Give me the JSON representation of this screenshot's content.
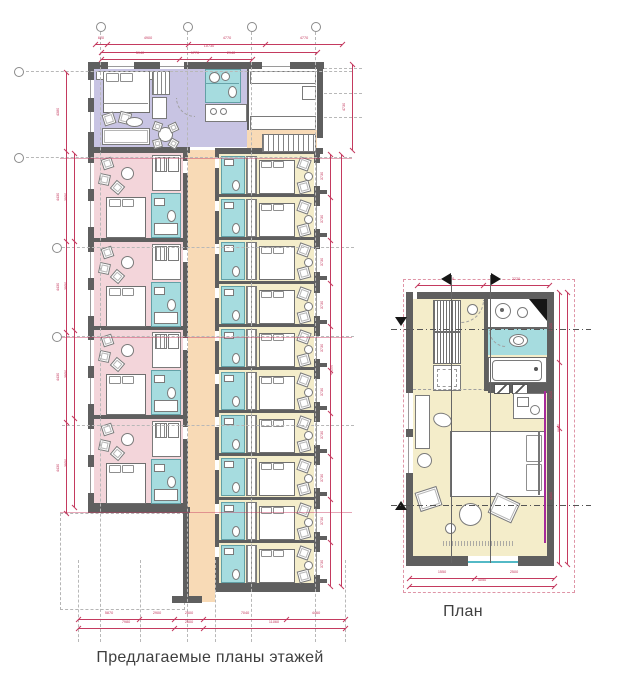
{
  "captions": {
    "main": "Предлагаемые планы этажей",
    "detail": "План"
  },
  "colors": {
    "wall": "#5f5f5f",
    "suite": "#c8c4e3",
    "room_large": "#f3d5da",
    "room_standard": "#f4edca",
    "bathroom": "#a6dcdf",
    "corridor": "#f8dab6",
    "dimension": "#c43a5f"
  },
  "main_plan": {
    "left_room_count": 4,
    "right_room_count": 10,
    "dims": {
      "top_outer": [
        "620",
        "4900",
        "4770",
        "4770"
      ],
      "top_overall": [
        "10730"
      ],
      "top_inner": [
        "5940",
        "1770",
        "2940"
      ],
      "top_right_side": [
        "4730"
      ],
      "bottom_row1": [
        "5870",
        "2900",
        "2600",
        "7040",
        "4460"
      ],
      "bottom_row2": [
        "7980",
        "2600",
        "11060"
      ],
      "left_outer": [
        "4380",
        "4430",
        "4430",
        "4430",
        "4430"
      ],
      "left_inner": [
        "3950",
        "3950",
        "3950",
        "3950"
      ],
      "right_rooms": [
        "3730",
        "3730",
        "3730",
        "3730",
        "3730",
        "3730",
        "3730",
        "3730",
        "3730",
        "3730"
      ],
      "right_overall": [
        "43200"
      ]
    }
  },
  "detail_plan": {
    "dims": {
      "top": [
        "1980",
        "2220"
      ],
      "right_inner": [
        "2220",
        "2020",
        "4380"
      ],
      "right_overall": [
        "8620"
      ],
      "bottom_inner": [
        "1550",
        "2500"
      ],
      "bottom_overall": [
        "4050"
      ]
    }
  }
}
